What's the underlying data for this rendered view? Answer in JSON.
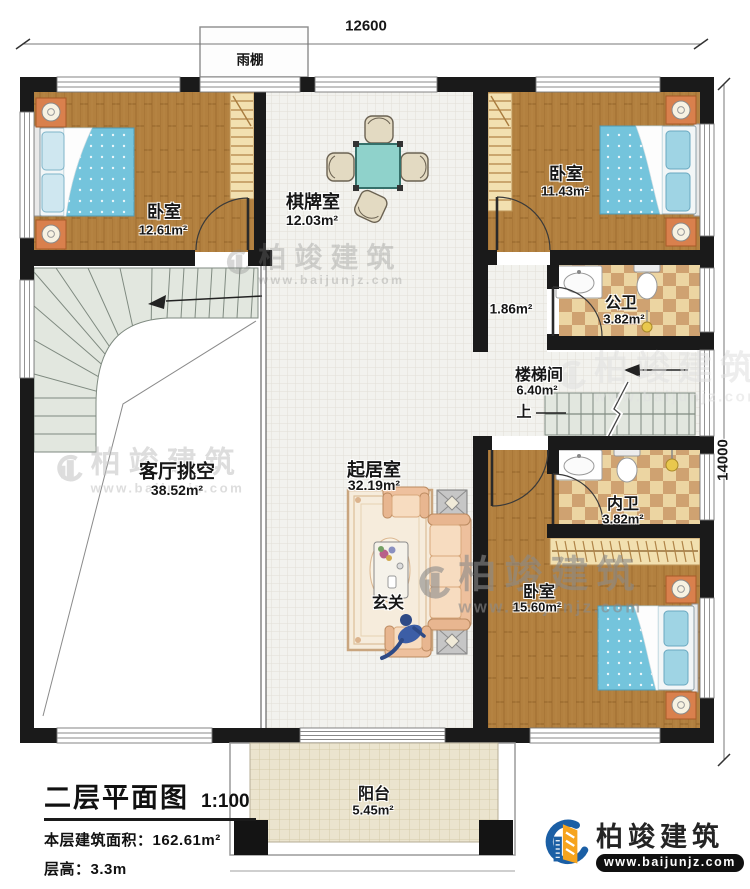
{
  "dimensions": {
    "width_label": "12600",
    "height_label": "14000"
  },
  "annotations": {
    "canopy": "雨棚",
    "up": "上"
  },
  "rooms": {
    "bedroom_top_left": {
      "name": "卧室",
      "area": "12.61m²"
    },
    "chess_room": {
      "name": "棋牌室",
      "area": "12.03m²"
    },
    "bedroom_top_right": {
      "name": "卧室",
      "area": "11.43m²"
    },
    "public_bathroom": {
      "name": "公卫",
      "area": "3.82m²"
    },
    "small_hall": {
      "area": "1.86m²"
    },
    "stairwell": {
      "name": "楼梯间",
      "area": "6.40m²"
    },
    "living_void": {
      "name": "客厅挑空",
      "area": "38.52m²"
    },
    "sitting_room": {
      "name": "起居室",
      "area": "32.19m²"
    },
    "private_bathroom": {
      "name": "内卫",
      "area": "3.82m²"
    },
    "bedroom_bottom_right": {
      "name": "卧室",
      "area": "15.60m²"
    },
    "foyer": {
      "name": "玄关"
    },
    "balcony": {
      "name": "阳台",
      "area": "5.45m²"
    }
  },
  "title_block": {
    "title": "二层平面图",
    "scale": "1:100",
    "building_area": "本层建筑面积：162.61m²",
    "floor_height": "层高：3.3m"
  },
  "logo": {
    "company": "柏竣建筑",
    "website": "www.baijunjz.com"
  },
  "watermark": {
    "company": "柏竣建筑",
    "website": "www.baijunjz.com"
  },
  "colors": {
    "wall": "#1a1a1a",
    "wood": "#b2803f",
    "tile": "#f2f2ee",
    "checker": "#cfa271",
    "stair": "#e2e7df",
    "bed": "#74c4dc",
    "nightstand": "#d9804d",
    "logo_blue": "#1b5fa5",
    "logo_orange": "#f6a41e"
  }
}
